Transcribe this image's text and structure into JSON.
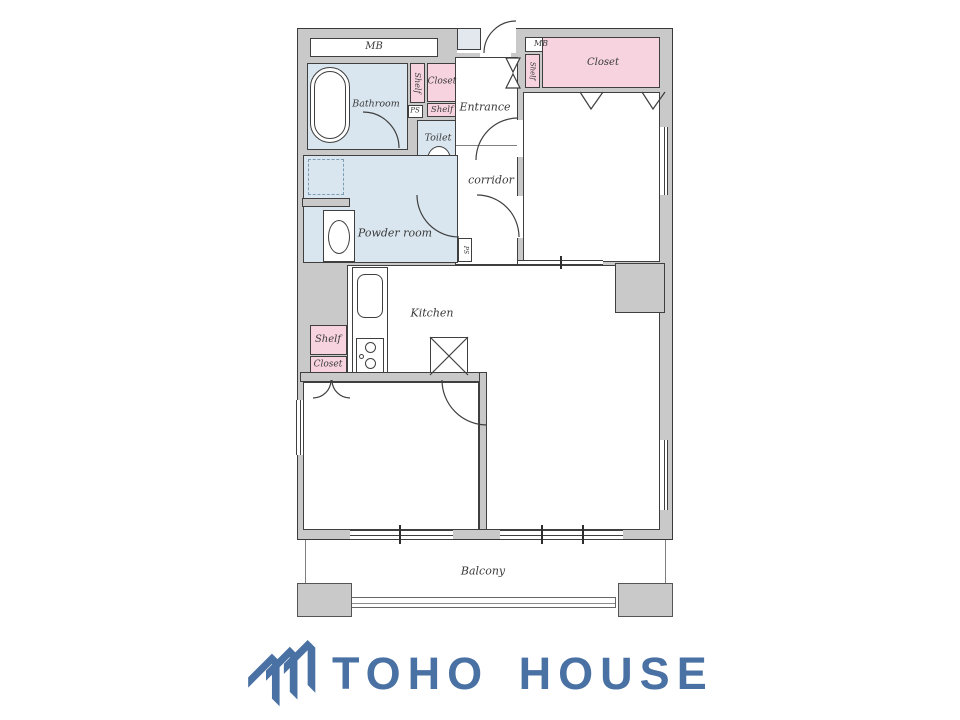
{
  "plan": {
    "labels": {
      "mb_left": "MB",
      "shelf_top_vertical": "Shelf",
      "closet_top": "Closet",
      "ps_top": "PS",
      "shelf_top": "Shelf",
      "bathroom": "Bathroom",
      "toilet": "Toilet",
      "entrance": "Entrance",
      "corridor": "corridor",
      "powder_room": "Powder room",
      "ps_corridor": "PS",
      "mb_right": "MB",
      "shelf_right_vertical": "Shelf",
      "closet_right": "Closet",
      "kitchen": "Kitchen",
      "shelf_kitchen": "Shelf",
      "closet_kitchen": "Closet",
      "balcony": "Balcony"
    },
    "colors": {
      "storage_pink": "#f7d3e0",
      "water_blue": "#d9e6ef",
      "wall_gray": "#c9c9c9",
      "outline": "#3f3f3f"
    }
  },
  "logo": {
    "text": "TOHO HOUSE",
    "color": "#4a71a3"
  }
}
